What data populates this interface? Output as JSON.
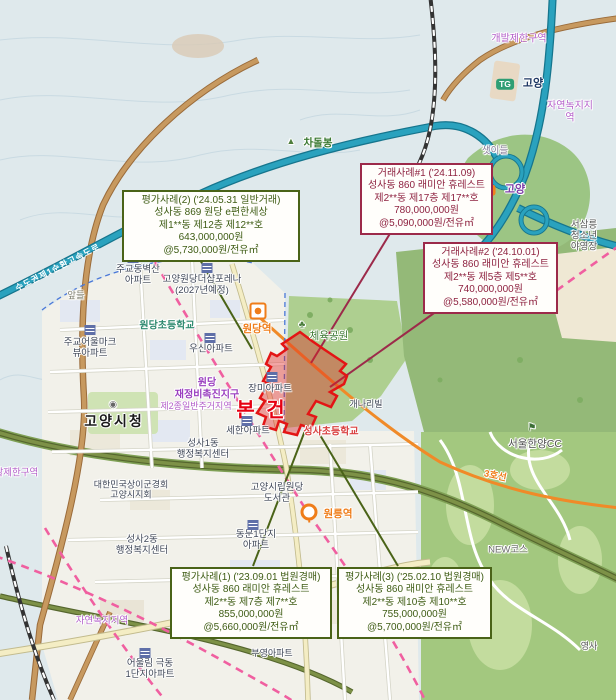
{
  "title": "감정평가 위치도 (고양시 성사동 860 래미안 휴레스트 본건 및 비교사례)",
  "colors": {
    "appraisal_green": "#3e5c14",
    "sale_maroon": "#8e2240",
    "subject_red": "#e60012",
    "subject_fill": "rgba(224,32,32,0.40)",
    "expressway_teal": "#2aa2be",
    "line3_orange": "#ef7d1a",
    "rail_pink": "#f05fa0",
    "zone_purple": "#b35fc9"
  },
  "callouts": {
    "appraisal2": {
      "type": "appraisal",
      "text": "평가사례(2) ('24.05.31 일반거래)\n성사동 869 원당 e편한세상\n제1**동 제12층 제12**호\n643,000,000원\n@5,730,000원/전유㎡"
    },
    "sale1": {
      "type": "sale",
      "text": "거래사례#1 ('24.11.09)\n성사동 860 래미안 휴레스트\n제2**동 제17층 제17**호\n780,000,000원\n@5,090,000원/전유㎡"
    },
    "sale2": {
      "type": "sale",
      "text": "거래사례#2 ('24.10.01)\n성사동 860 래미안 휴레스트\n제2**동 제5층 제5**호\n740,000,000원\n@5,580,000원/전유㎡"
    },
    "appraisal1": {
      "type": "appraisal",
      "text": "평가사례(1) ('23.09.01 법원경매)\n성사동 860 래미안 휴레스트\n제2**동 제7층 제7**호\n855,000,000원\n@5,660,000원/전유㎡"
    },
    "appraisal3": {
      "type": "appraisal",
      "text": "평가사례(3) ('25.02.10 법원경매)\n성사동 860 래미안 휴레스트\n제2**동 제10층 제10**호\n755,000,000원\n@5,700,000원/전유㎡"
    }
  },
  "map": {
    "subject_polygon": [
      [
        300,
        332
      ],
      [
        282,
        344
      ],
      [
        287,
        349
      ],
      [
        277,
        356
      ],
      [
        271,
        353
      ],
      [
        266,
        364
      ],
      [
        271,
        367
      ],
      [
        263,
        381
      ],
      [
        268,
        384
      ],
      [
        260,
        398
      ],
      [
        265,
        401
      ],
      [
        257,
        413
      ],
      [
        266,
        417
      ],
      [
        263,
        426
      ],
      [
        276,
        430
      ],
      [
        279,
        421
      ],
      [
        287,
        424
      ],
      [
        284,
        432
      ],
      [
        297,
        435
      ],
      [
        301,
        425
      ],
      [
        311,
        428
      ],
      [
        316,
        417
      ],
      [
        308,
        414
      ],
      [
        316,
        401
      ],
      [
        331,
        407
      ],
      [
        337,
        396
      ],
      [
        330,
        392
      ],
      [
        344,
        384
      ],
      [
        347,
        376
      ],
      [
        340,
        371
      ],
      [
        346,
        364
      ],
      [
        325,
        350
      ],
      [
        312,
        341
      ]
    ],
    "leaders": [
      {
        "name": "leader-appraisal2",
        "from": [
          196,
          253
        ],
        "to": [
          252,
          349
        ],
        "color": "#4a6318"
      },
      {
        "name": "leader-sale1",
        "from": [
          394,
          227
        ],
        "to": [
          311,
          363
        ],
        "color": "#9c2a4a"
      },
      {
        "name": "leader-sale2",
        "from": [
          444,
          306
        ],
        "to": [
          330,
          387
        ],
        "color": "#9c2a4a"
      },
      {
        "name": "leader-appraisal1",
        "from": [
          253,
          566
        ],
        "to": [
          306,
          428
        ],
        "color": "#4a6318"
      },
      {
        "name": "leader-appraisal3",
        "from": [
          398,
          566
        ],
        "to": [
          317,
          430
        ],
        "color": "#4a6318"
      }
    ],
    "labels": [
      {
        "name": "peak-chadolbong-icon",
        "text": "▲",
        "cx": 291,
        "cy": 141,
        "color": "#4e7d3c",
        "size": 9
      },
      {
        "name": "peak-chadolbong",
        "text": "차돌봉",
        "cx": 318,
        "cy": 143,
        "color": "#3c7a33",
        "size": 10.5,
        "bold": 1
      },
      {
        "name": "zone-greenbelt-top",
        "text": "개발제한구역",
        "cx": 519,
        "cy": 39,
        "color": "#b35fc9",
        "size": 10
      },
      {
        "name": "zone-natural-green-right",
        "text": "자연녹지지역",
        "cx": 570,
        "cy": 112,
        "color": "#b35fc9",
        "size": 10
      },
      {
        "name": "place-saetideul",
        "text": "샛이들",
        "cx": 495,
        "cy": 152,
        "color": "#8a7f9a",
        "size": 9.5
      },
      {
        "name": "tollgate-badge",
        "text": "TG",
        "cx": 505,
        "cy": 84,
        "cls": "badge",
        "bg": "#2f9e74"
      },
      {
        "name": "tollgate-goyang",
        "text": "고양",
        "cx": 533,
        "cy": 84,
        "color": "#1f3864",
        "size": 11,
        "bold": 1
      },
      {
        "name": "junction-badge",
        "text": "JC",
        "cx": 487,
        "cy": 190,
        "cls": "badge",
        "bg": "#f0821e"
      },
      {
        "name": "junction-goyang",
        "text": "고양",
        "cx": 515,
        "cy": 190,
        "color": "#7d3fa8",
        "size": 11,
        "bold": 1
      },
      {
        "name": "place-seosamneung-camp",
        "text": "서삼릉청소년\n야영장",
        "cx": 584,
        "cy": 237,
        "color": "#555555",
        "size": 9.5
      },
      {
        "name": "road-ring-expressway",
        "text": "수도권제1순환고속도로",
        "cx": 58,
        "cy": 268,
        "color": "#ffffff",
        "size": 8.5,
        "rotate": -27,
        "bold": 1,
        "ls": 1,
        "nohalo": 1
      },
      {
        "name": "apt-jugyo-byeoksan",
        "text": "주교동벽산\n아파트",
        "cx": 138,
        "cy": 276,
        "color": "#3f4757",
        "size": 9.5
      },
      {
        "name": "apt-thesharp-forena",
        "text": "고양원당더샵포레나\n(2027년예정)",
        "cx": 202,
        "cy": 286,
        "color": "#3f4757",
        "size": 9.5
      },
      {
        "name": "place-apdeul",
        "text": "앞들",
        "cx": 76,
        "cy": 297,
        "color": "#7d7d6d",
        "size": 9.5
      },
      {
        "name": "school-wondang-elem",
        "text": "원당초등학교",
        "cx": 167,
        "cy": 326,
        "color": "#2f8a70",
        "size": 10,
        "bold": 1
      },
      {
        "name": "apt-jugyo-viewpark",
        "text": "주교어울마크\n뷰아파트",
        "cx": 90,
        "cy": 349,
        "color": "#3f4757",
        "size": 9.5
      },
      {
        "name": "apt-woosin",
        "text": "우신아파트",
        "cx": 211,
        "cy": 350,
        "color": "#3f4757",
        "size": 9.5
      },
      {
        "name": "zone-wondang-promotion",
        "text": "원당\n재정비촉진지구",
        "cx": 207,
        "cy": 389,
        "color": "#9a3fbf",
        "size": 10,
        "bold": 1
      },
      {
        "name": "zone-residential",
        "text": "제2종일반주거지역",
        "cx": 196,
        "cy": 406,
        "color": "#b35fc9",
        "size": 9
      },
      {
        "name": "goyang-cityhall-icon",
        "text": "◉",
        "cx": 113,
        "cy": 404,
        "color": "#666666",
        "size": 9
      },
      {
        "name": "goyang-cityhall",
        "text": "고양시청",
        "cx": 114,
        "cy": 421,
        "color": "#1a1a1a",
        "size": 14,
        "bold": 1,
        "ls": 2
      },
      {
        "name": "apt-jangmi",
        "text": "장미아파트",
        "cx": 270,
        "cy": 390,
        "color": "#3f4757",
        "size": 9.5
      },
      {
        "name": "station-wondang-icon",
        "cx": 258,
        "cy": 311,
        "cls": "icon-station"
      },
      {
        "name": "station-wondang",
        "text": "원당역",
        "cx": 257,
        "cy": 329,
        "color": "#ef7d1a",
        "size": 10.5,
        "bold": 1
      },
      {
        "name": "park-sports-icon",
        "text": "♣",
        "cx": 302,
        "cy": 325,
        "color": "#4e8040",
        "size": 10
      },
      {
        "name": "park-sports",
        "text": "체육공원",
        "cx": 329,
        "cy": 336,
        "color": "#3e7a35",
        "size": 10.5
      },
      {
        "name": "subject-label",
        "text": "본 건",
        "cx": 262,
        "cy": 411,
        "color": "#e60012",
        "size": 20,
        "bold": 1,
        "ls": 3
      },
      {
        "name": "apt-sehan",
        "text": "세한아파트",
        "cx": 248,
        "cy": 432,
        "color": "#3f4757",
        "size": 9.5
      },
      {
        "name": "school-seongsa-elem",
        "text": "성사초등학교",
        "cx": 331,
        "cy": 432,
        "color": "#d94040",
        "size": 10,
        "bold": 1
      },
      {
        "name": "apt-gaenari",
        "text": "개나리빌",
        "cx": 366,
        "cy": 404,
        "color": "#3f4757",
        "size": 9
      },
      {
        "name": "center-seongsa1",
        "text": "성사1동\n행정복지센터",
        "cx": 203,
        "cy": 450,
        "color": "#3f4757",
        "size": 9.5
      },
      {
        "name": "org-veterans-goyang",
        "text": "대한민국상이군경회\n고양시지회",
        "cx": 131,
        "cy": 490,
        "color": "#3f4757",
        "size": 9
      },
      {
        "name": "library-wondang",
        "text": "고양시립원당\n도서관",
        "cx": 277,
        "cy": 494,
        "color": "#3f4757",
        "size": 9.5
      },
      {
        "name": "apt-dongmun1",
        "text": "동문1단지\n아파트",
        "cx": 256,
        "cy": 541,
        "color": "#3f4757",
        "size": 9.5
      },
      {
        "name": "station-wolleung-pin",
        "cx": 309,
        "cy": 512,
        "cls": "icon-pin"
      },
      {
        "name": "station-wolleung",
        "text": "원릉역",
        "cx": 338,
        "cy": 514,
        "color": "#ef7d1a",
        "size": 10.5,
        "bold": 1
      },
      {
        "name": "center-seongsa2",
        "text": "성사2동\n행정복지센터",
        "cx": 142,
        "cy": 546,
        "color": "#3f4757",
        "size": 9.5
      },
      {
        "name": "zone-natural-green-bottom",
        "text": "자연녹지지역",
        "cx": 102,
        "cy": 622,
        "color": "#b35fc9",
        "size": 9.5
      },
      {
        "name": "apt-ulim-geukdong",
        "text": "어울림 극동\n1단지아파트",
        "cx": 150,
        "cy": 670,
        "color": "#3f4757",
        "size": 9.5
      },
      {
        "name": "apt-buyeong",
        "text": "부영아파트",
        "cx": 272,
        "cy": 653,
        "color": "#3f4757",
        "size": 9
      },
      {
        "name": "golf-flag-icon",
        "text": "⚑",
        "cx": 532,
        "cy": 428,
        "color": "#3c6e35",
        "size": 10
      },
      {
        "name": "golf-hanyang-cc",
        "text": "서울한양CC",
        "cx": 535,
        "cy": 444,
        "color": "#4f4f4f",
        "size": 10.5
      },
      {
        "name": "subway-line3",
        "text": "3호선",
        "cx": 495,
        "cy": 477,
        "color": "#ef7d1a",
        "size": 9.5,
        "bold": 1,
        "rotate": 12
      },
      {
        "name": "golf-new-course",
        "text": "NEW코스",
        "cx": 508,
        "cy": 551,
        "color": "#6d6d6d",
        "size": 9.5
      },
      {
        "name": "zone-greenbelt-left",
        "text": "개발제한구역",
        "cx": 12,
        "cy": 474,
        "color": "#b35fc9",
        "size": 9.5
      },
      {
        "name": "place-yeongsa",
        "text": "영사",
        "cx": 589,
        "cy": 646,
        "color": "#555555",
        "size": 9
      },
      {
        "name": "apt-icon-1",
        "cx": 133,
        "cy": 258,
        "cls": "icon-apt"
      },
      {
        "name": "apt-icon-2",
        "cx": 207,
        "cy": 268,
        "cls": "icon-apt"
      },
      {
        "name": "apt-icon-3",
        "cx": 90,
        "cy": 330,
        "cls": "icon-apt"
      },
      {
        "name": "apt-icon-4",
        "cx": 210,
        "cy": 338,
        "cls": "icon-apt"
      },
      {
        "name": "apt-icon-5",
        "cx": 272,
        "cy": 377,
        "cls": "icon-apt"
      },
      {
        "name": "apt-icon-6",
        "cx": 247,
        "cy": 421,
        "cls": "icon-apt"
      },
      {
        "name": "apt-icon-7",
        "cx": 253,
        "cy": 525,
        "cls": "icon-apt"
      },
      {
        "name": "apt-icon-8",
        "cx": 145,
        "cy": 653,
        "cls": "icon-apt"
      }
    ]
  }
}
